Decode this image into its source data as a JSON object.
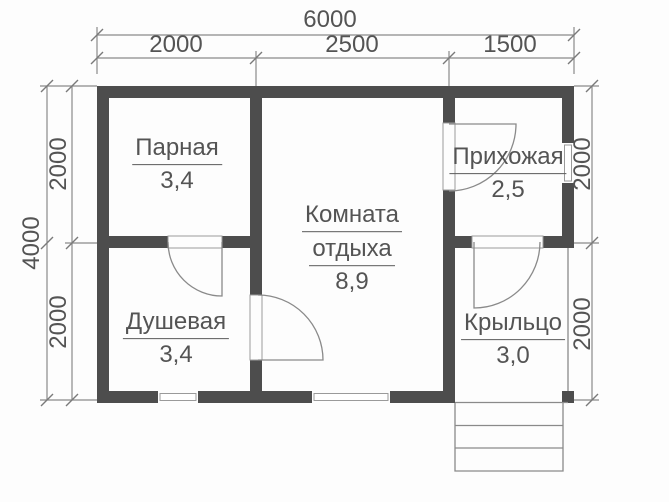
{
  "colors": {
    "wall": "#4d4d4d",
    "thin_line": "#8a8a8a",
    "text": "#545454",
    "background": "#fdfdfd"
  },
  "dimensions": {
    "top_total": "6000",
    "top_segments": [
      "2000",
      "2500",
      "1500"
    ],
    "left_total": "4000",
    "left_segments": [
      "2000",
      "2000"
    ],
    "right_segments": [
      "2000",
      "2000"
    ]
  },
  "rooms": {
    "parnaya": {
      "name": "Парная",
      "area": "3,4"
    },
    "komnata_otdyha": {
      "name_line1": "Комната",
      "name_line2": "отдыха",
      "area": "8,9"
    },
    "dushevaya": {
      "name": "Душевая",
      "area": "3,4"
    },
    "prihozhaya": {
      "name": "Прихожая",
      "area": "2,5"
    },
    "kryltso": {
      "name": "Крыльцо",
      "area": "3,0"
    }
  }
}
